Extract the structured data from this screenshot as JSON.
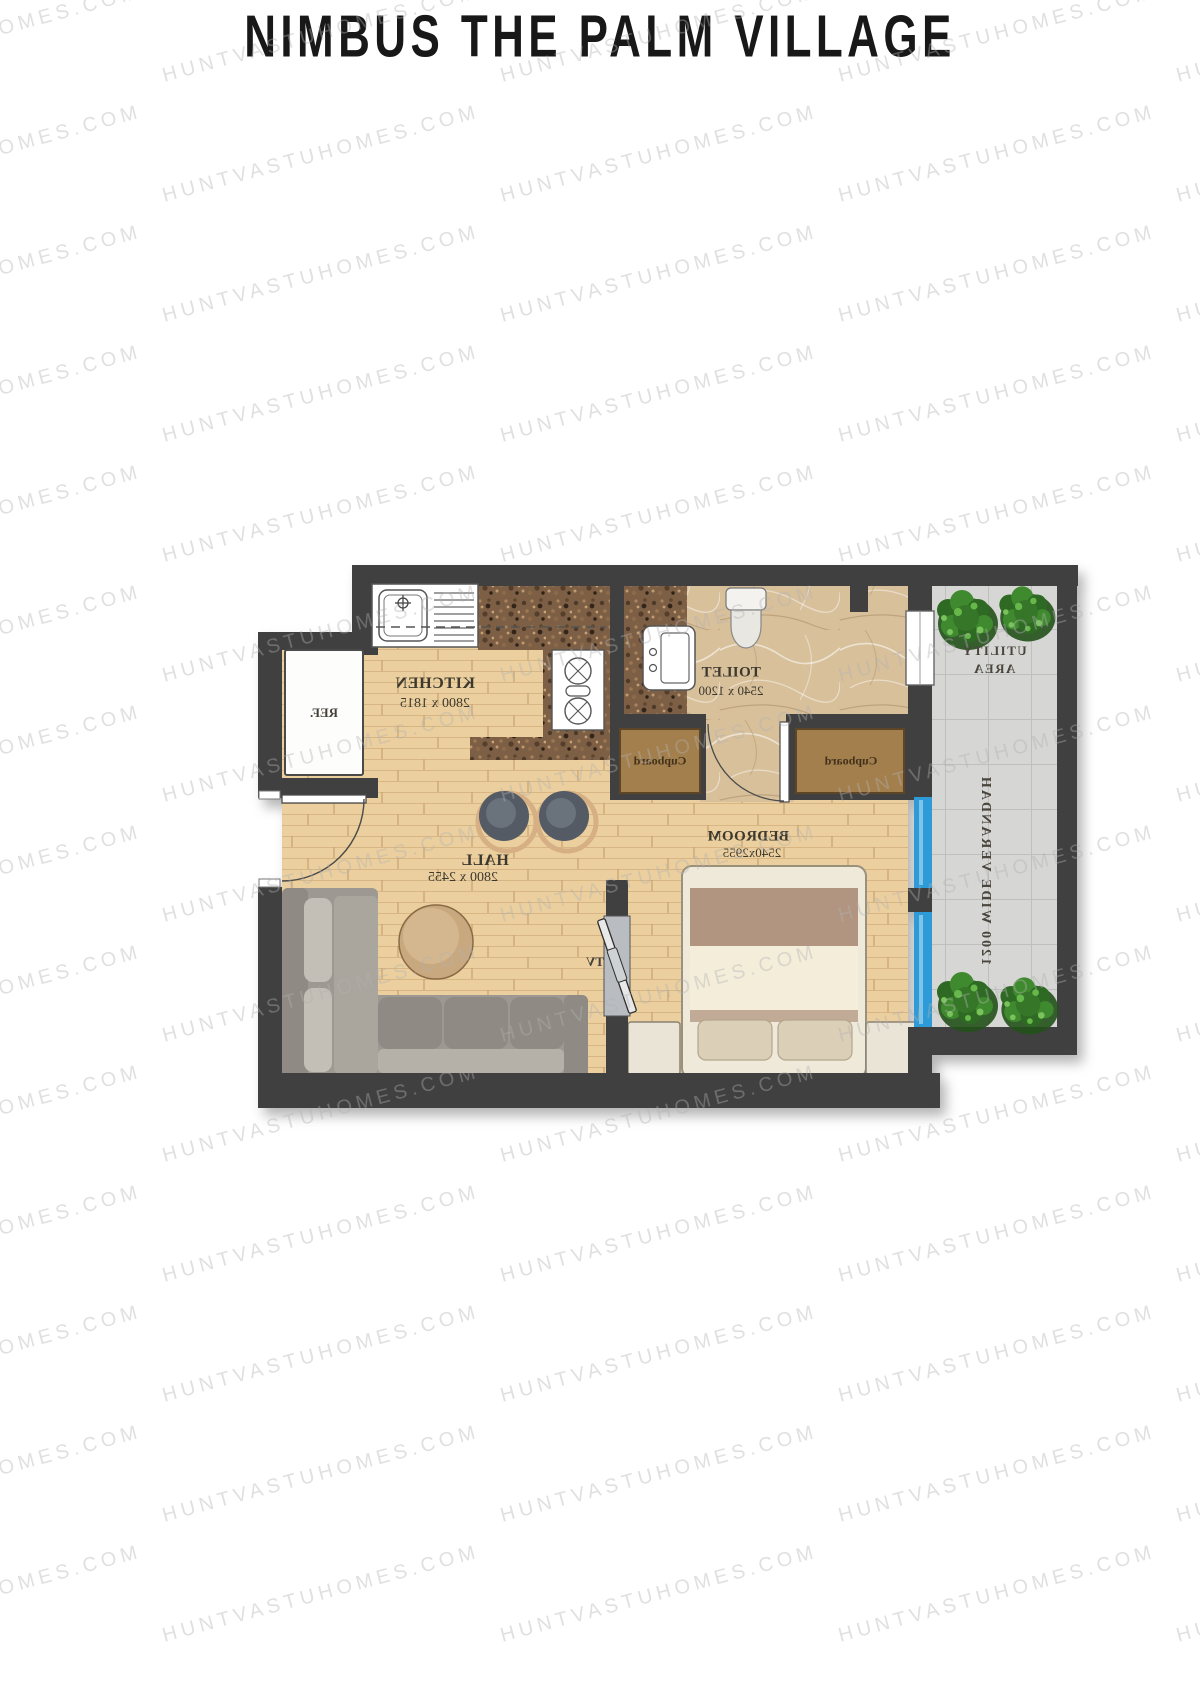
{
  "title": "NIMBUS THE PALM VILLAGE",
  "watermark": {
    "text": "HUNTVASTUHOMES.COM"
  },
  "floor_plan": {
    "text_is_mirrored": true,
    "rooms": {
      "kitchen": {
        "name": "KITCHEN",
        "dimensions": "2800 x 1815"
      },
      "toilet": {
        "name": "TOILET",
        "dimensions": "2540 x 1200"
      },
      "hall": {
        "name": "HALL",
        "dimensions": "2800 x 2455"
      },
      "bedroom": {
        "name": "BEDROOM",
        "dimensions": "2540x2955"
      },
      "utility_area": {
        "line1": "UTILITY",
        "line2": "AREA"
      },
      "verandah": {
        "name": "1200 WIDE VERANDAH"
      }
    },
    "fixtures": {
      "cupboard": "Cupboard",
      "refrigerator": "REF.",
      "tv": "TV"
    },
    "colors": {
      "wall": "#404040",
      "wood_floor": "#ebcf9e",
      "granite_counter": "#7d5f45",
      "marble_floor": "#d8c09b",
      "verandah_tile": "#d6d6d4",
      "window_blue": "#2e9bd8",
      "plant_green": "#3f8a2e",
      "label_text": "#3d392f",
      "title_text": "#181818",
      "watermark_gray": "#e4e4e4"
    }
  }
}
